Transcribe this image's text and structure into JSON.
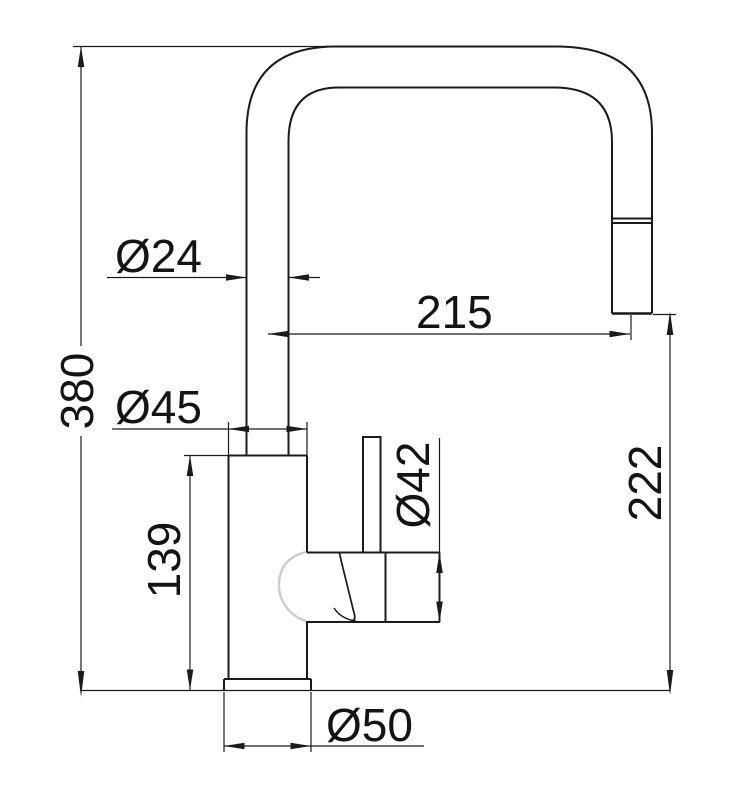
{
  "drawing": {
    "subject": "kitchen-faucet-dimension-drawing",
    "colors": {
      "background": "#ffffff",
      "object_line": "#1b1b1b",
      "dimension_line": "#1b1b1b",
      "hidden_dome_line": "#cccccc",
      "text": "#141414"
    },
    "dimensions": {
      "overall_height": {
        "label": "380"
      },
      "spout_tube_diameter": {
        "label": "Ø24"
      },
      "spout_reach": {
        "label": "215"
      },
      "body_diameter": {
        "label": "Ø45"
      },
      "body_height": {
        "label": "139"
      },
      "valve_housing_diameter": {
        "label": "Ø42"
      },
      "outlet_height": {
        "label": "222"
      },
      "base_diameter": {
        "label": "Ø50"
      }
    }
  }
}
